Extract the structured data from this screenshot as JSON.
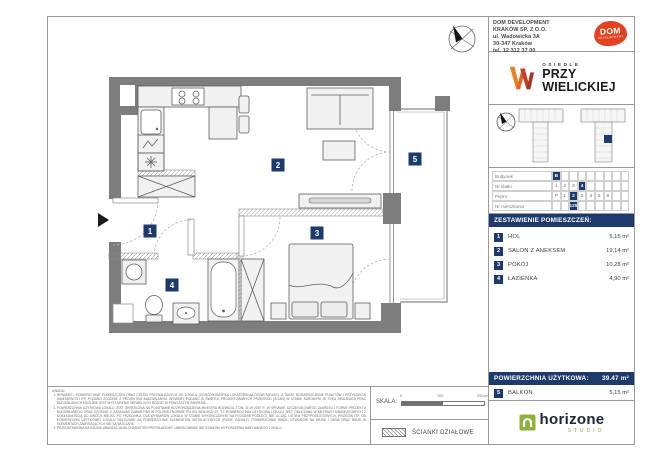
{
  "developer": {
    "lines": [
      "DOM DEVELOPMENT",
      "KRAKÓW SP. Z O.O.",
      "ul. Wadowicka 3A",
      "30-347 Kraków",
      "tel. 12 312 37 00"
    ],
    "logo_text": "DOM",
    "logo_subtext": "DEVELOPMENT"
  },
  "estate": {
    "name_top": "OSIEDLE",
    "name_line1": "PRZY",
    "name_line2": "WIELICKIEJ"
  },
  "unit_table": {
    "rows": [
      {
        "label": "Budynek",
        "cells": [
          "B",
          "",
          "",
          "",
          "",
          "",
          "",
          "",
          ""
        ],
        "highlight": 0
      },
      {
        "label": "Nr klatki",
        "cells": [
          "1",
          "2",
          "3",
          "4",
          "",
          "",
          "",
          "",
          ""
        ],
        "highlight": 3
      },
      {
        "label": "Piętro",
        "cells": [
          "P",
          "1",
          "2",
          "3",
          "4",
          "5",
          "6",
          "",
          ""
        ],
        "highlight": 2
      },
      {
        "label": "Nr mieszkania",
        "cells": [
          "",
          "",
          "125",
          "",
          "",
          "",
          "",
          "",
          ""
        ],
        "highlight": 2
      }
    ]
  },
  "room_schedule": {
    "title": "ZESTAWIENIE POMIESZCZEŃ:",
    "rooms": [
      {
        "no": "1",
        "name": "HOL",
        "area": "5,15 m²"
      },
      {
        "no": "2",
        "name": "SALON Z ANEKSEM",
        "area": "19,14 m²"
      },
      {
        "no": "3",
        "name": "POKÓJ",
        "area": "10,28 m²"
      },
      {
        "no": "4",
        "name": "ŁAZIENKA",
        "area": "4,90 m²"
      }
    ],
    "total_label": "POWIERZCHNIA UŻYTKOWA:",
    "total_value": "39.47 m²",
    "extra": {
      "no": "5",
      "name": "BALKON",
      "area": "5,15 m²"
    }
  },
  "floor_plan": {
    "labels": [
      {
        "n": "1",
        "x": 149,
        "y": 230
      },
      {
        "n": "2",
        "x": 277,
        "y": 164
      },
      {
        "n": "3",
        "x": 316,
        "y": 232
      },
      {
        "n": "4",
        "x": 171,
        "y": 284
      },
      {
        "n": "5",
        "x": 414,
        "y": 158
      }
    ]
  },
  "studio": {
    "name": "horizone",
    "sub": "STUDIO"
  },
  "footer": {
    "disclaimer_title": "UWAGA:",
    "disclaimer_items": [
      "WYMIARY I POWIERZCHNIE POMIESZCZEŃ ORAZ CZĘŚCI PRZYNALEŻNYCH DO LOKALU (OGRÓD/KOMÓRKA LOKATORSKA/LOGGIE/TARASY), A TAKŻE ROZMIESZCZENIE PUNKTÓW I PRZYBORÓW SANITARNYCH ITP. PODANO ZGODNIE Z PROJEKTEM BUDOWLANYM. WYMIARY PODANO W ŚWIETLE PROJEKTOWANYCH PRZEGRÓD (ŚCIAN) W STANIE SUROWYM. W TOKU REALIZACJI PRAC BUDOWLANYCH MOŻLIWE JEST WYSTĄPIENIE NIEWIELKICH RÓŻNIC W POWYŻSZYM ZAKRESIE.",
      "POWIERZCHNIA UŻYTKOWA LOKALU JEST OKREŚLONA NA PODSTAWIE ROZPORZĄDZENIA MINISTRA ROZWOJU Z DN. 11.09.2020 R. W SPRAWIE SZCZEGÓŁOWEGO ZAKRESU I FORMY PROJEKTU BUDOWLANEGO ORAZ ZGODNIE Z ZASADAMI ZAWARTYMI W POLSKIEJ NORMIE PN-ISO 9836:2022-07, TJ. POWIERZCHNIA UŻYTKOWA LOKALU JEST OBLICZANA W METRACH KWADRATOWYCH Z DOKŁADNOŚCIĄ DO DWÓCH MIEJSC PO PRZECINKU, DLA WYMIARÓW LOKALU W STANIE WYKOŃCZONYM, NA POZIOMIE PODŁOGI, NIE LICZĄC LISTEW PRZYPODŁOGOWYCH, PROGÓW ITP. OD POWIERZCHNI UŻYTKOWEJ LOKALU ODLICZANE SĄ POWIERZCHNIE ELEMENTÓW INSTALACYJNYCH (PIONY, KANAŁY). POWIERZCHNIE WNĘK, OTWORÓW NA DRZWI I OKNA ORAZ NISZE W ELEMENTACH ZAMYKAJĄCYCH NIE SĄ WLICZANE.",
      "PRZEDSTAWIONA NA RZUCIE ARANŻACJA MA CHARAKTER PRZYKŁADOWY. UMEBLOWANIE NIE STANOWI WYPOSAŻENIA NABYWANEGO LOKALU."
    ],
    "scale": {
      "label": "SKALA:",
      "tick_start": "0",
      "tick_mid": "100",
      "tick_end": "200cm"
    },
    "legend": {
      "label": "ŚCIANKI DZIAŁOWE"
    }
  },
  "colors": {
    "navy": "#1d3a6d",
    "brand_red": "#e5401f",
    "brand_orange": "#ee7f1f",
    "studio_green": "#9aab3c",
    "wall_gray": "#7d7d7d"
  }
}
